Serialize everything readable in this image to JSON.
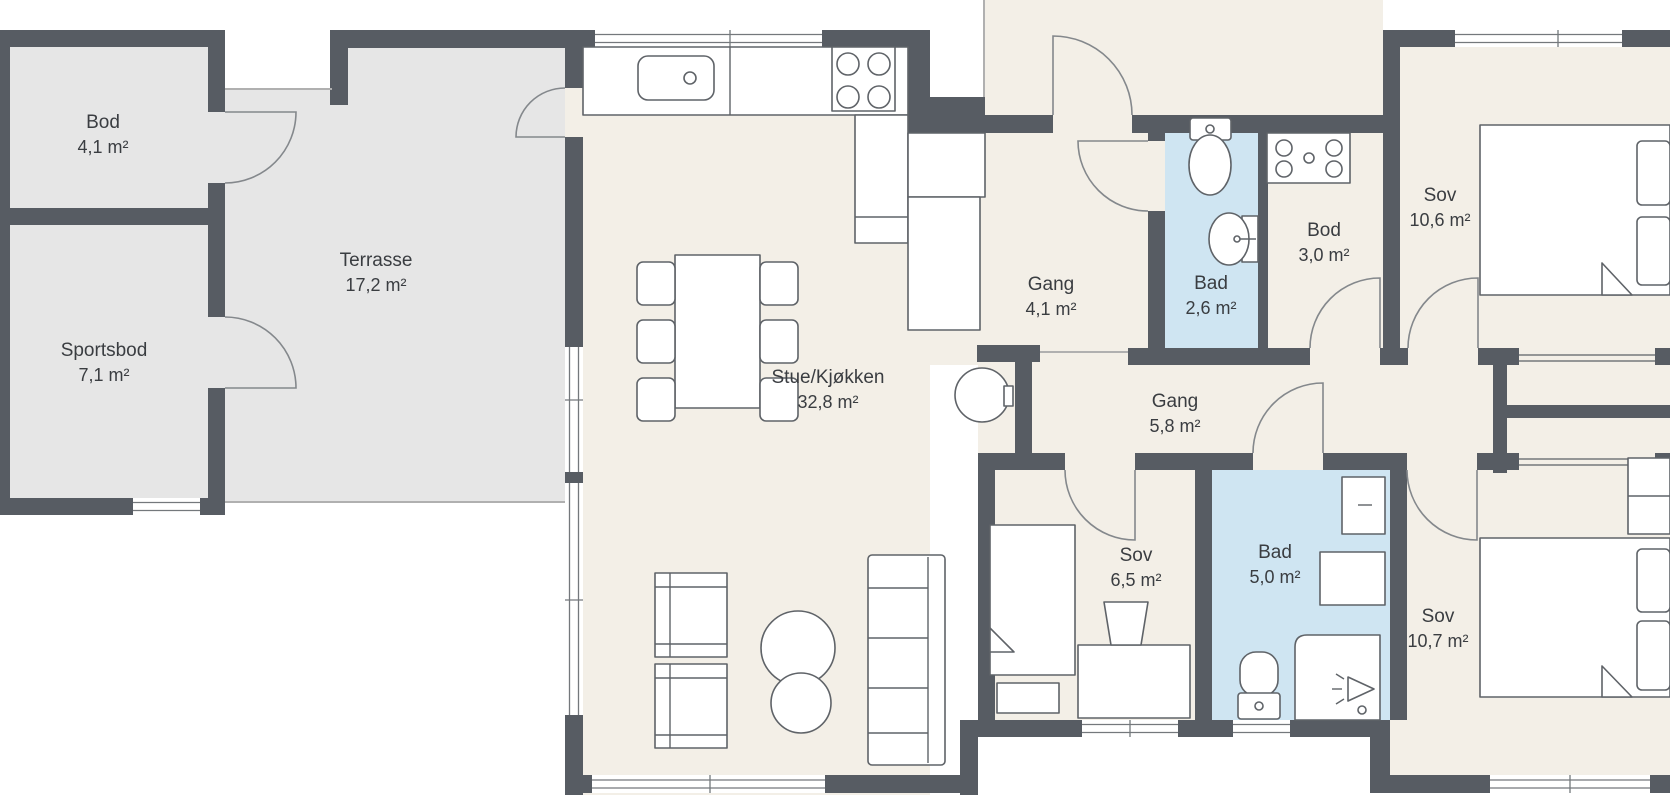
{
  "plan_title": "Floor plan (Norwegian housing unit)",
  "palette": {
    "wall": "#575c63",
    "floor": "#f3efe7",
    "wet": "#cfe5f2",
    "outdoor": "#e6e6e6",
    "line": "#5f6368",
    "thin": "#b0b0b0",
    "text": "#3a3d41",
    "white": "#ffffff"
  },
  "rooms": [
    {
      "name": "Bod",
      "area": "4,1 m²"
    },
    {
      "name": "Sportsbod",
      "area": "7,1 m²"
    },
    {
      "name": "Terrasse",
      "area": "17,2 m²"
    },
    {
      "name": "Stue/Kjøkken",
      "area": "32,8 m²"
    },
    {
      "name": "Gang",
      "area": "4,1 m²"
    },
    {
      "name": "Bad",
      "area": "2,6 m²"
    },
    {
      "name": "Bod",
      "area": "3,0 m²"
    },
    {
      "name": "Sov",
      "area": "10,6 m²"
    },
    {
      "name": "Gang",
      "area": "5,8 m²"
    },
    {
      "name": "Sov",
      "area": "6,5 m²"
    },
    {
      "name": "Bad",
      "area": "5,0 m²"
    },
    {
      "name": "Sov",
      "area": "10,7 m²"
    }
  ]
}
